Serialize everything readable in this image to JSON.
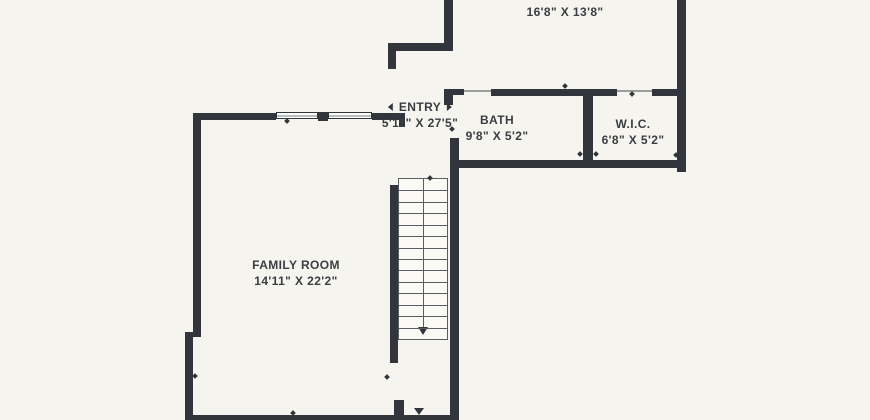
{
  "plan_title": "floor-plan",
  "colors": {
    "background": "#f5f4ef",
    "wall": "#32363c",
    "text": "#3a3d42",
    "stair_line": "#5a5d61"
  },
  "rooms": [
    {
      "name": "",
      "dimensions": "16'8\" X 13'8\""
    },
    {
      "name": "ENTRY",
      "dimensions": "5'11\" X 27'5\""
    },
    {
      "name": "BATH",
      "dimensions": "9'8\" X 5'2\""
    },
    {
      "name": "W.I.C.",
      "dimensions": "6'8\" X 5'2\""
    },
    {
      "name": "FAMILY ROOM",
      "dimensions": "14'11\" X 22'2\""
    }
  ],
  "stairs": {
    "tread_count": 14,
    "direction": "down"
  }
}
